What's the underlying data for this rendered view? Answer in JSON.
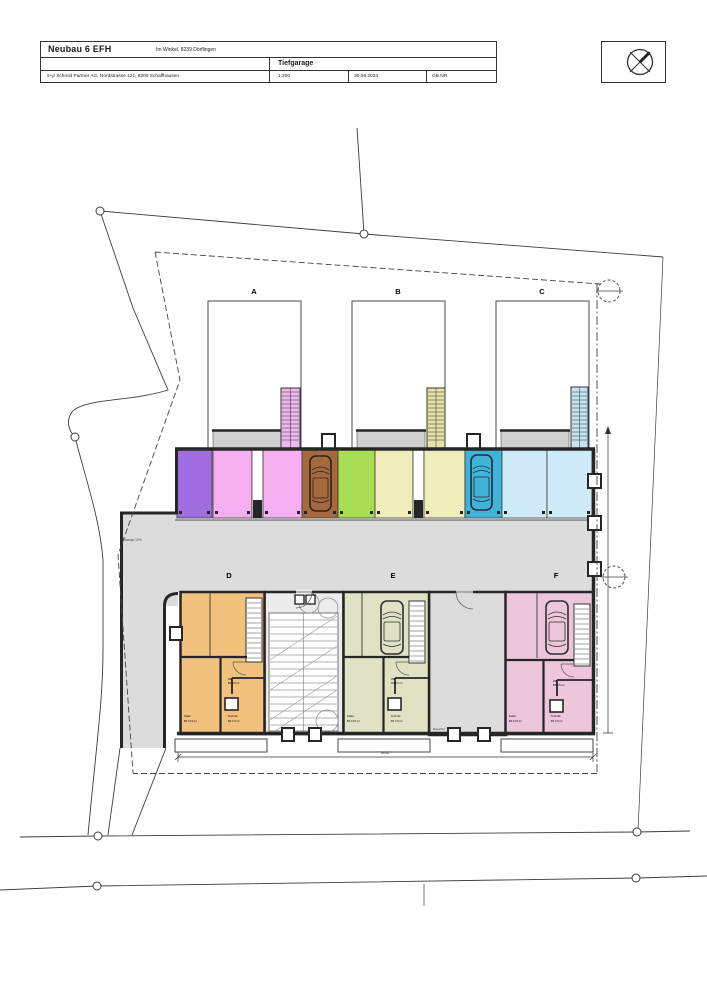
{
  "title_block": {
    "project": "Neubau 6 EFH",
    "address": "Im Winkel, 8239 Dörflingen",
    "sheet": "Tiefgarage",
    "firm": "s+p Schmid Partner AG, Nordstrasse 121, 8200 Schaffhausen",
    "scale": "1:200",
    "date": "30.09.2024",
    "parcel": "GB.NR."
  },
  "plan": {
    "house_labels": [
      "A",
      "B",
      "C"
    ],
    "unit_labels": [
      "D",
      "E",
      "F"
    ],
    "ramp_label": "Rampe 12%",
    "zone_label": "Besucher",
    "dim_width": "49.30",
    "room": {
      "wasch": "Wa",
      "wasch_area": "BF 3.5 m²",
      "keller": "Keller",
      "keller_area": "BF 13.5 m²",
      "technik": "Technik",
      "technik_area": "BF 4.5 m²"
    }
  },
  "colors": {
    "wall": "#262626",
    "floor_gray": "#dcdcdc",
    "corridor_gray": "#ececec",
    "platform_gray": "#d0d0d0",
    "stall_purple": "#a06ee0",
    "stall_pink": "#f5aeef",
    "stall_brown": "#a5693f",
    "stall_green": "#a9de52",
    "stall_cream": "#f1edbb",
    "stall_blue": "#41b3d8",
    "stall_lightblue": "#cfeaf8",
    "unit_d": "#f2c17e",
    "unit_e": "#dfe3c3",
    "unit_f": "#edc7d9",
    "shaft_a": "#eeb7ed",
    "shaft_b": "#e7e3a4",
    "shaft_c": "#c4e4f4"
  }
}
